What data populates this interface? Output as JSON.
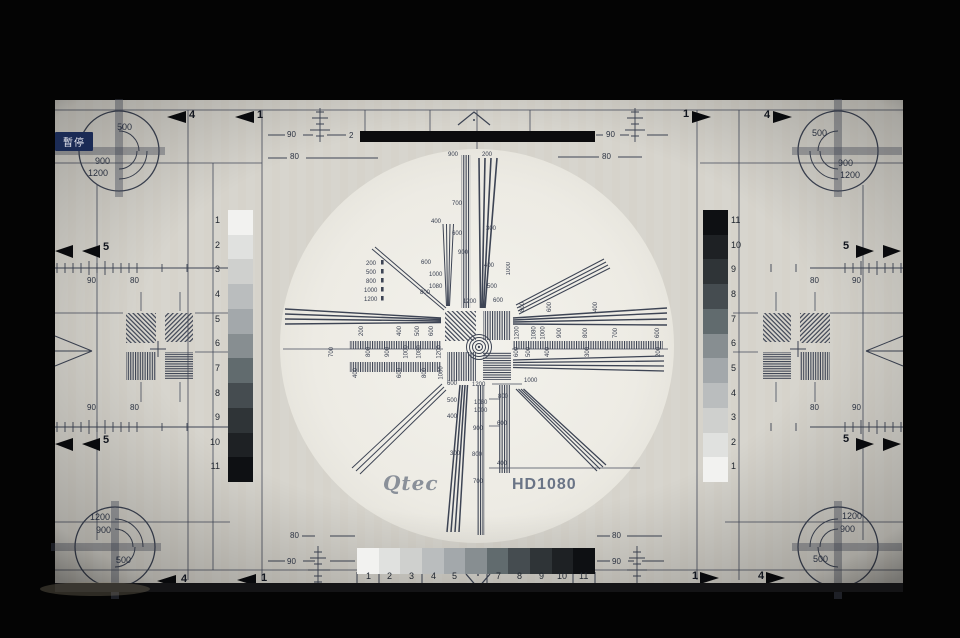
{
  "osd": {
    "pause_badge": "暫停"
  },
  "branding": {
    "logo": "Qtec",
    "model": "HD1080"
  },
  "colors": {
    "card_bg": "#d7d5ce",
    "circle_bg": "#eeece5",
    "line": "#3d4454",
    "black_bar": "#0b0b0d",
    "badge_bg": "#1b2b55",
    "badge_text": "#e9eaf2",
    "logo_gray": "#8a9099",
    "model_gray": "#6a7486"
  },
  "corners": {
    "tl": [
      "500",
      "900",
      "1200"
    ],
    "tr": [
      "500",
      "900",
      "1200"
    ],
    "bl": [
      "1200",
      "900",
      "500"
    ],
    "br": [
      "1200",
      "900",
      "500"
    ]
  },
  "edges": {
    "top": [
      "4",
      "1",
      "1",
      "4"
    ],
    "bottom": [
      "4",
      "1",
      "1",
      "4"
    ],
    "left": [
      "5",
      "5"
    ],
    "right": [
      "5",
      "5"
    ]
  },
  "rulers": {
    "top_left_90": "90",
    "top_2": "2",
    "top_right_90": "90",
    "top_left_80": "80",
    "top_right_80": "80",
    "bottom_left_80": "80",
    "bottom_left_90": "90",
    "bottom_right_80": "80",
    "bottom_right_90": "90",
    "mid_left_top": [
      "90",
      "80"
    ],
    "mid_left_bottom": [
      "90",
      "80"
    ],
    "mid_right_top": [
      "80",
      "90"
    ],
    "mid_right_bottom": [
      "80",
      "90"
    ]
  },
  "grayscale": {
    "steps": [
      "#f2f2f0",
      "#e0e1df",
      "#cfd0ce",
      "#babdbe",
      "#a3a8ab",
      "#878e91",
      "#616b6e",
      "#454c50",
      "#2f3437",
      "#1e2124",
      "#0e1013"
    ],
    "left_labels": [
      "1",
      "2",
      "3",
      "4",
      "5",
      "6",
      "7",
      "8",
      "9",
      "10",
      "11"
    ],
    "right_labels": [
      "11",
      "10",
      "9",
      "8",
      "7",
      "6",
      "5",
      "4",
      "3",
      "2",
      "1"
    ],
    "bottom_labels": [
      "1",
      "2",
      "3",
      "4",
      "5",
      "",
      "7",
      "8",
      "9",
      "10",
      "11"
    ]
  },
  "circle": {
    "top_band": [
      "900",
      "200"
    ],
    "top_labels": [
      "700",
      "400",
      "300",
      "600",
      "900",
      "600",
      "400",
      "1000",
      "1080",
      "800",
      "500",
      "600",
      "1200"
    ],
    "top_list": [
      "200",
      "500",
      "800",
      "1000",
      "1200"
    ],
    "top_rot": "1000",
    "left_row1": [
      "200",
      "400",
      "500",
      "600"
    ],
    "left_row2": [
      "700",
      "800",
      "900",
      "1000",
      "1080",
      "1200"
    ],
    "left_row3": [
      "400",
      "600",
      "800",
      "1000"
    ],
    "right_row1": [
      "800",
      "600",
      "400"
    ],
    "right_row2": [
      "1200",
      "1080",
      "1000",
      "900",
      "800",
      "700",
      "600"
    ],
    "right_row3": [
      "600",
      "500",
      "400",
      "300",
      "200"
    ],
    "bottom_left": [
      "600",
      "500",
      "400",
      "300"
    ],
    "bottom_mid": [
      "1200",
      "1080",
      "1000",
      "900",
      "800",
      "700"
    ],
    "bottom_right": [
      "800",
      "600",
      "400"
    ],
    "diag_label": "1000"
  }
}
